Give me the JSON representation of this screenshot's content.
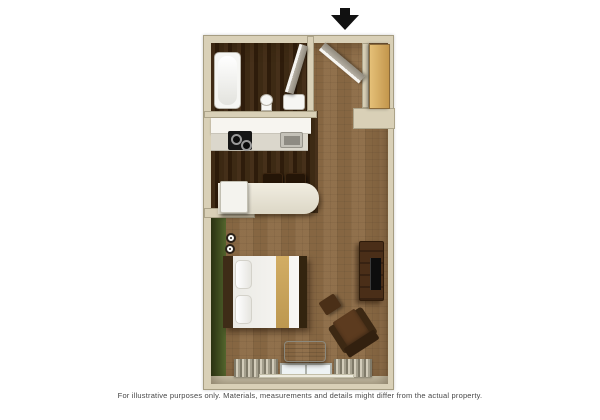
{
  "caption": "For illustrative purposes only.  Materials, measurements and details might differ from the actual property.",
  "entrance": {
    "arrow_icon": "down-arrow"
  },
  "colors": {
    "canvas": "#ffffff",
    "wall": "#d9d0b7",
    "carpet": "#8d6c46",
    "wood_floor": "#34210f",
    "accent_wall": "#49602a",
    "counter": "#f7f5f0",
    "closet_door": "#d4a85f",
    "dark_furniture": "#4a2e18"
  },
  "furniture": [
    "bathtub",
    "toilet",
    "vanity-sink",
    "bathroom-door",
    "entry-door",
    "closet-door",
    "kitchen-counter",
    "cooktop",
    "kitchen-sink",
    "bar-stool",
    "bar-stool",
    "peninsula-counter",
    "refrigerator",
    "wall-lamp",
    "wall-lamp",
    "bed",
    "tv-stand",
    "tv",
    "armchair",
    "ottoman",
    "ac-unit",
    "window",
    "curtain",
    "curtain"
  ]
}
